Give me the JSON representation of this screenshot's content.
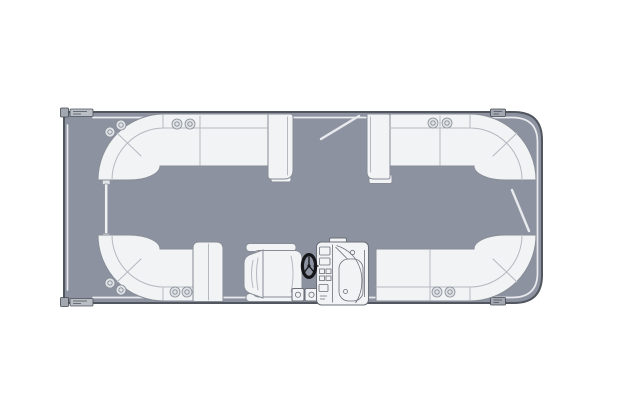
{
  "colors": {
    "background": "#ffffff",
    "deck": "#8d92a0",
    "hull-stroke": "#51565f",
    "upholstery": "#f2f3f5",
    "upholstery-stroke": "#878d96",
    "seam": "#b4b9c0",
    "rail": "#e8eaee",
    "cupholder": "#dfe2e6",
    "wheel": "#15161a",
    "console-stroke": "#6b7079"
  },
  "scene": {
    "type": "floor-plan",
    "subject": "Pontoon boat deck layout, top view, bow at left",
    "components": [
      {
        "id": "deck",
        "label": "Pontoon deck platform"
      },
      {
        "id": "bow-lounge-upper",
        "label": "Wraparound bow lounge, upper left"
      },
      {
        "id": "bow-lounge-lower",
        "label": "Wraparound bow lounge, lower left"
      },
      {
        "id": "stern-lounge-upper",
        "label": "Wraparound stern lounge, upper right"
      },
      {
        "id": "stern-lounge-lower",
        "label": "Wraparound stern lounge, lower right"
      },
      {
        "id": "bow-gate",
        "label": "Bow boarding gate, closed"
      },
      {
        "id": "side-gate",
        "label": "Side boarding gate, shown swung open"
      },
      {
        "id": "stern-gate",
        "label": "Stern boarding gate, shown swung open"
      },
      {
        "id": "captains-chair",
        "label": "Captain's helm chair"
      },
      {
        "id": "helm-console",
        "label": "Helm console with gauges and windscreen"
      },
      {
        "id": "steering-wheel",
        "label": "Steering wheel"
      },
      {
        "id": "cup-holders",
        "label": "Cup holder pair"
      },
      {
        "id": "cleats",
        "label": "Mooring cleat"
      },
      {
        "id": "armrests",
        "label": "Lounge armrest panel"
      }
    ]
  }
}
